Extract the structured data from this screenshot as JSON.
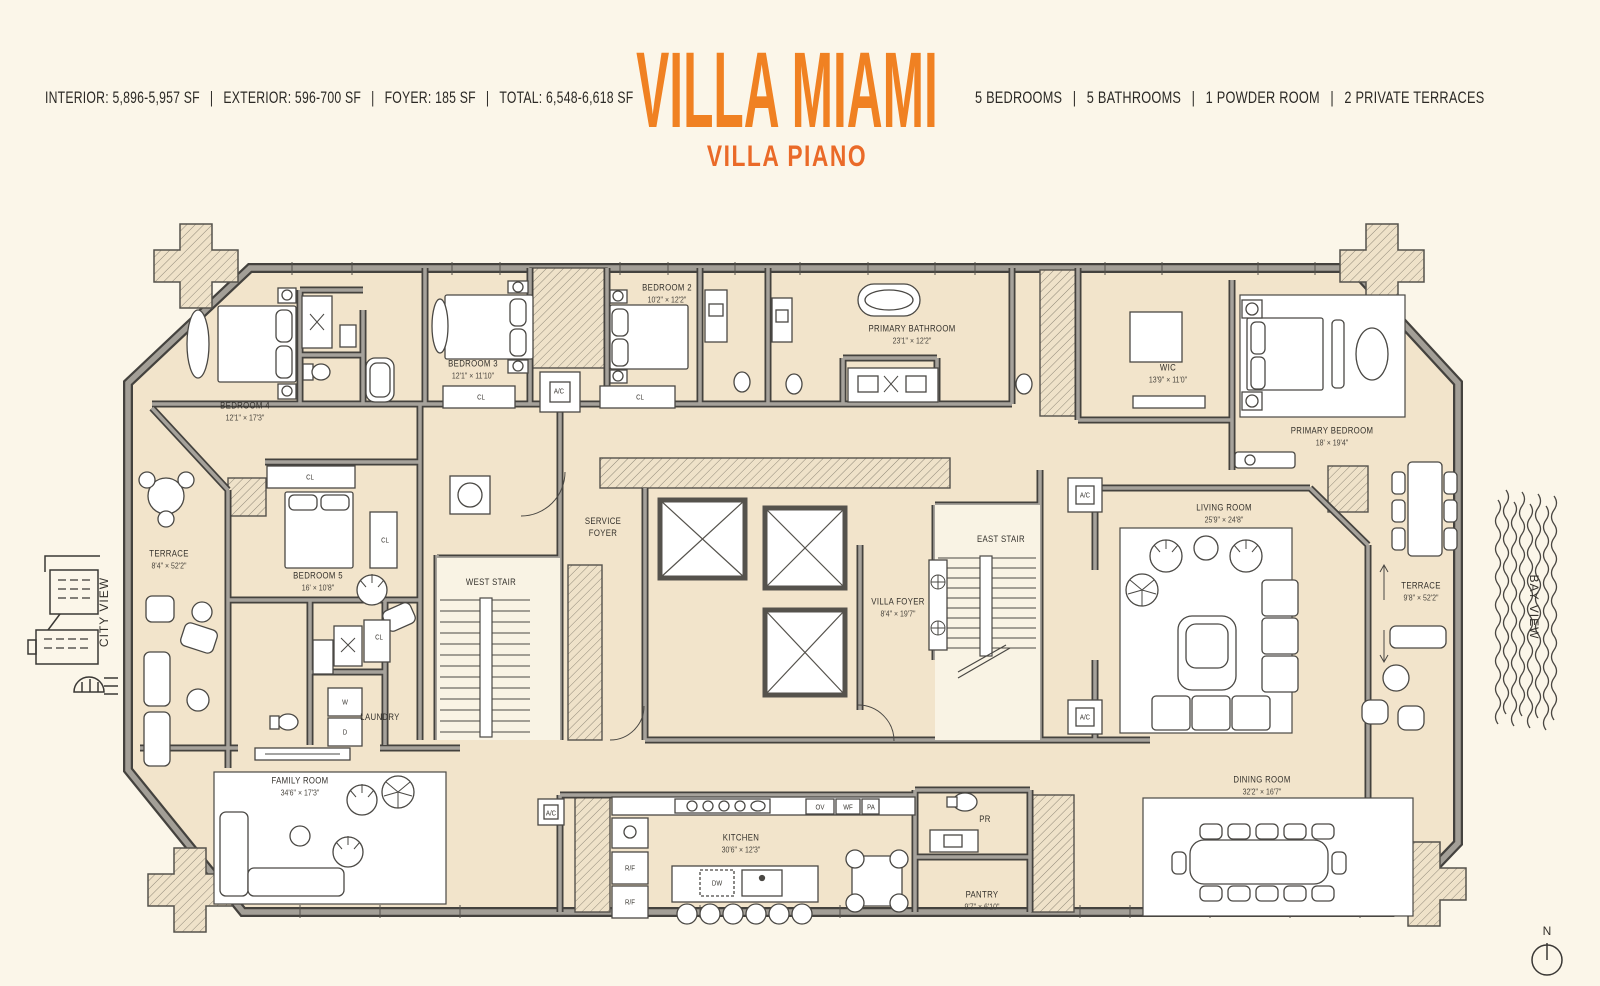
{
  "header": {
    "stats_left": [
      "INTERIOR: 5,896-5,957 SF",
      "EXTERIOR: 596-700 SF",
      "FOYER: 185 SF",
      "TOTAL: 6,548-6,618 SF"
    ],
    "divider": "|",
    "title": "VILLA MIAMI",
    "subtitle": "VILLA PIANO",
    "stats_right": [
      "5 BEDROOMS",
      "5 BATHROOMS",
      "1 POWDER ROOM",
      "2 PRIVATE TERRACES"
    ]
  },
  "colors": {
    "title_orange": "#F08122",
    "subtitle_orange": "#EA6A28",
    "background": "#FBF6E9",
    "floor_tan": "#F2E4CB",
    "wall_gray": "#9C9890",
    "ink": "#33302B"
  },
  "plan": {
    "rooms": [
      {
        "id": "bedroom-4",
        "name": "BEDROOM 4",
        "dims": "12'1\" × 17'3\"",
        "x": 245,
        "y": 412
      },
      {
        "id": "bedroom-3",
        "name": "BEDROOM 3",
        "dims": "12'1\" × 11'10\"",
        "x": 473,
        "y": 370
      },
      {
        "id": "bedroom-2",
        "name": "BEDROOM 2",
        "dims": "10'2\" × 12'2\"",
        "x": 667,
        "y": 294
      },
      {
        "id": "primary-bathroom",
        "name": "PRIMARY BATHROOM",
        "dims": "23'1\" × 12'2\"",
        "x": 912,
        "y": 335
      },
      {
        "id": "wic",
        "name": "WIC",
        "dims": "13'9\" × 11'0\"",
        "x": 1168,
        "y": 374
      },
      {
        "id": "primary-bedroom",
        "name": "PRIMARY BEDROOM",
        "dims": "18' × 19'4\"",
        "x": 1332,
        "y": 437
      },
      {
        "id": "terrace-left",
        "name": "TERRACE",
        "dims": "8'4\" × 52'2\"",
        "x": 169,
        "y": 560
      },
      {
        "id": "bedroom-5",
        "name": "BEDROOM 5",
        "dims": "16' × 10'8\"",
        "x": 318,
        "y": 582
      },
      {
        "id": "service-foyer",
        "name": "SERVICE\nFOYER",
        "dims": "",
        "x": 603,
        "y": 528
      },
      {
        "id": "west-stair",
        "name": "WEST STAIR",
        "dims": "",
        "x": 491,
        "y": 583
      },
      {
        "id": "villa-foyer",
        "name": "VILLA FOYER",
        "dims": "8'4\" × 19'7\"",
        "x": 898,
        "y": 608
      },
      {
        "id": "east-stair",
        "name": "EAST STAIR",
        "dims": "",
        "x": 1001,
        "y": 540
      },
      {
        "id": "living-room",
        "name": "LIVING ROOM",
        "dims": "25'9\" × 24'8\"",
        "x": 1224,
        "y": 514
      },
      {
        "id": "terrace-right",
        "name": "TERRACE",
        "dims": "9'8\" × 52'2\"",
        "x": 1421,
        "y": 592
      },
      {
        "id": "laundry",
        "name": "LAUNDRY",
        "dims": "",
        "x": 380,
        "y": 718
      },
      {
        "id": "family-room",
        "name": "FAMILY ROOM",
        "dims": "34'6\" × 17'3\"",
        "x": 300,
        "y": 787
      },
      {
        "id": "kitchen",
        "name": "KITCHEN",
        "dims": "30'6\" × 12'3\"",
        "x": 741,
        "y": 844
      },
      {
        "id": "pantry",
        "name": "PANTRY",
        "dims": "9'7\" × 6'10\"",
        "x": 982,
        "y": 901
      },
      {
        "id": "dining-room",
        "name": "DINING ROOM",
        "dims": "32'2\" × 16'7\"",
        "x": 1262,
        "y": 786
      },
      {
        "id": "powder-room",
        "name": "PR",
        "dims": "",
        "x": 985,
        "y": 820
      }
    ],
    "fixtures": [
      {
        "label": "CL",
        "x": 481,
        "y": 397
      },
      {
        "label": "CL",
        "x": 640,
        "y": 397
      },
      {
        "label": "A/C",
        "x": 559,
        "y": 391
      },
      {
        "label": "CL",
        "x": 310,
        "y": 477
      },
      {
        "label": "CL",
        "x": 385,
        "y": 540
      },
      {
        "label": "CL",
        "x": 379,
        "y": 637
      },
      {
        "label": "W",
        "x": 345,
        "y": 702
      },
      {
        "label": "D",
        "x": 345,
        "y": 732
      },
      {
        "label": "R/F",
        "x": 630,
        "y": 868
      },
      {
        "label": "R/F",
        "x": 630,
        "y": 902
      },
      {
        "label": "DW",
        "x": 717,
        "y": 883
      },
      {
        "label": "OV",
        "x": 820,
        "y": 807
      },
      {
        "label": "WF",
        "x": 848,
        "y": 807
      },
      {
        "label": "PA",
        "x": 871,
        "y": 807
      },
      {
        "label": "A/C",
        "x": 1085,
        "y": 495
      },
      {
        "label": "A/C",
        "x": 1085,
        "y": 717
      },
      {
        "label": "A/C",
        "x": 551,
        "y": 813
      }
    ],
    "views": [
      {
        "id": "city-view",
        "label": "CITY VIEW",
        "x": 104,
        "y": 612,
        "rotate": -90
      },
      {
        "id": "bay-view",
        "label": "BAY VIEW",
        "x": 1534,
        "y": 607,
        "rotate": 90
      }
    ],
    "compass": {
      "label": "N",
      "x": 1547,
      "y": 931
    }
  }
}
